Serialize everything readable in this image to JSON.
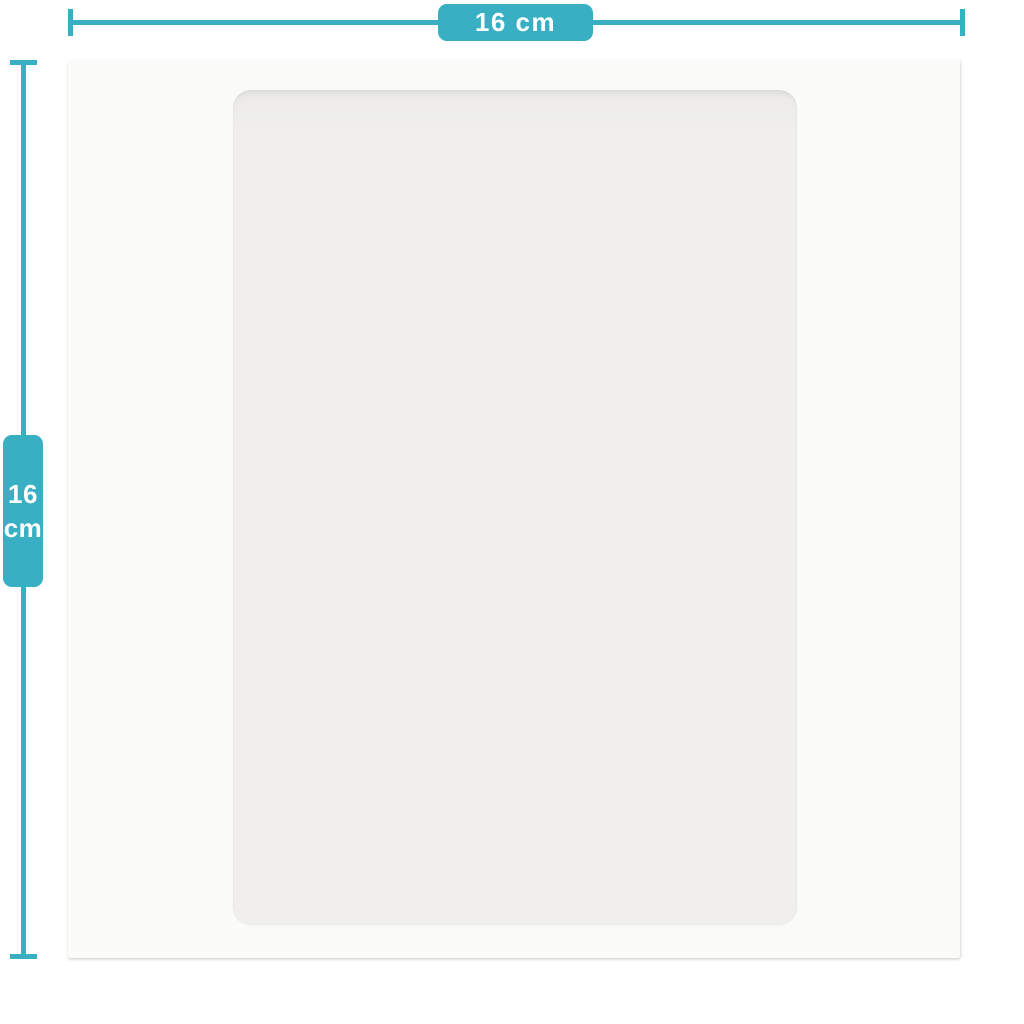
{
  "diagram": {
    "width_dimension": {
      "label": "16 cm"
    },
    "height_dimension": {
      "value": "16",
      "unit": "cm"
    },
    "colors": {
      "accent": "#38afc3",
      "label_text": "#ffffff",
      "product_face": "#fbfbfa",
      "panel_face": "#f0efed",
      "background": "#ffffff"
    }
  }
}
